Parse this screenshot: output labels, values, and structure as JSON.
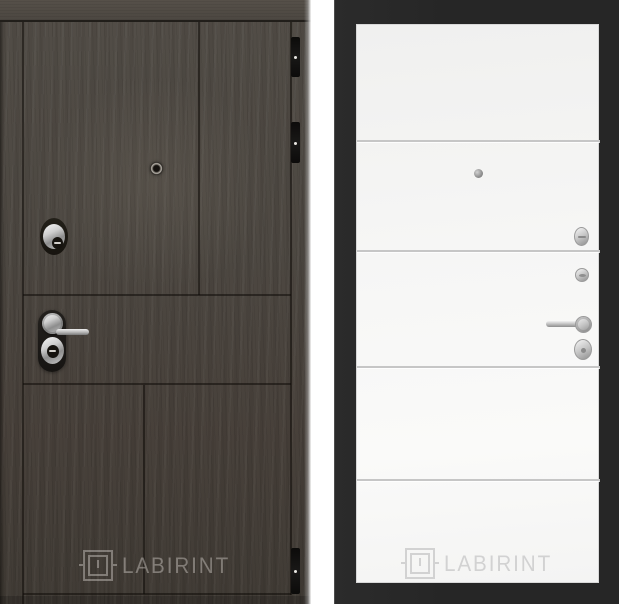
{
  "brand": "LABIRINT",
  "left_panel": {
    "watermark": "LABIRINT",
    "colors": {
      "wood": "#4b4640",
      "wood_dark": "#3f3a34",
      "groove": "#211e1a",
      "hinge": "#121110",
      "chrome": "#c9c9c9",
      "watermark": "rgba(219,215,209,0.42)"
    }
  },
  "gap": {
    "color": "#ffffff"
  },
  "right_panel": {
    "watermark": "LABIRINT",
    "colors": {
      "background": "#272727",
      "leaf": "#f6f6f5",
      "trim_line": "#c6c6c6",
      "hardware": "#bdbdbd",
      "watermark": "#d2d2d2"
    }
  }
}
